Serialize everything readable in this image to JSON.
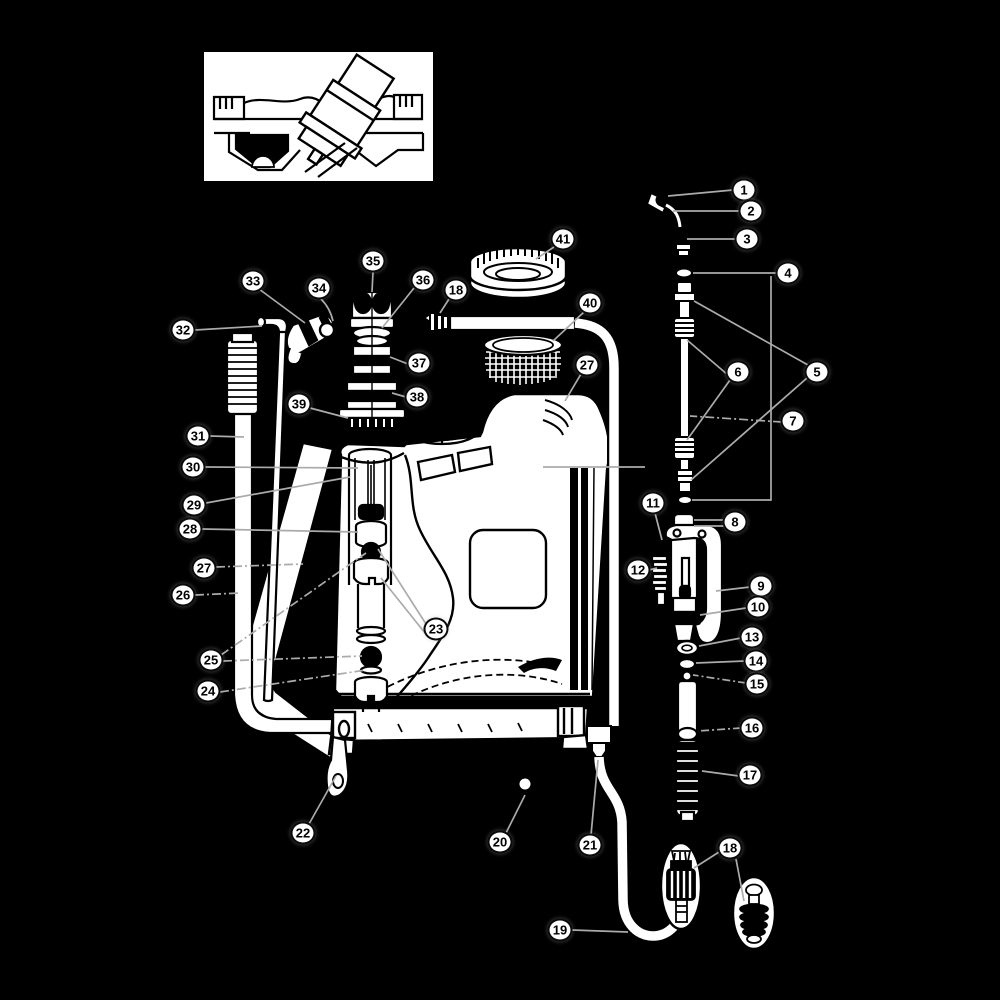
{
  "figure": {
    "type": "exploded-parts-diagram",
    "subject": "backpack-sprayer",
    "background_color": "#000000",
    "ink_color": "#000000",
    "paper_color": "#ffffff",
    "leader_line_color": "#ababab",
    "callout_count": 41
  },
  "callouts": [
    {
      "label": "1",
      "x": 744,
      "y": 190
    },
    {
      "label": "2",
      "x": 751,
      "y": 211
    },
    {
      "label": "3",
      "x": 747,
      "y": 239
    },
    {
      "label": "4",
      "x": 788,
      "y": 273
    },
    {
      "label": "5",
      "x": 817,
      "y": 372
    },
    {
      "label": "6",
      "x": 738,
      "y": 372
    },
    {
      "label": "7",
      "x": 793,
      "y": 421
    },
    {
      "label": "8",
      "x": 735,
      "y": 522
    },
    {
      "label": "9",
      "x": 761,
      "y": 586
    },
    {
      "label": "10",
      "x": 758,
      "y": 607
    },
    {
      "label": "11",
      "x": 653,
      "y": 503
    },
    {
      "label": "12",
      "x": 638,
      "y": 570
    },
    {
      "label": "13",
      "x": 752,
      "y": 637
    },
    {
      "label": "14",
      "x": 756,
      "y": 661
    },
    {
      "label": "15",
      "x": 757,
      "y": 684
    },
    {
      "label": "16",
      "x": 752,
      "y": 728
    },
    {
      "label": "17",
      "x": 750,
      "y": 775
    },
    {
      "label": "18",
      "x": 456,
      "y": 290
    },
    {
      "label": "18",
      "x": 730,
      "y": 848
    },
    {
      "label": "19",
      "x": 560,
      "y": 930
    },
    {
      "label": "20",
      "x": 500,
      "y": 842
    },
    {
      "label": "21",
      "x": 590,
      "y": 845
    },
    {
      "label": "22",
      "x": 303,
      "y": 833
    },
    {
      "label": "23",
      "x": 436,
      "y": 629
    },
    {
      "label": "24",
      "x": 208,
      "y": 691
    },
    {
      "label": "25",
      "x": 211,
      "y": 660
    },
    {
      "label": "26",
      "x": 183,
      "y": 595
    },
    {
      "label": "27",
      "x": 204,
      "y": 568
    },
    {
      "label": "27",
      "x": 587,
      "y": 365
    },
    {
      "label": "28",
      "x": 190,
      "y": 529
    },
    {
      "label": "29",
      "x": 194,
      "y": 505
    },
    {
      "label": "30",
      "x": 193,
      "y": 467
    },
    {
      "label": "31",
      "x": 198,
      "y": 436
    },
    {
      "label": "32",
      "x": 183,
      "y": 330
    },
    {
      "label": "33",
      "x": 253,
      "y": 281
    },
    {
      "label": "34",
      "x": 319,
      "y": 288
    },
    {
      "label": "35",
      "x": 373,
      "y": 261
    },
    {
      "label": "36",
      "x": 423,
      "y": 280
    },
    {
      "label": "37",
      "x": 419,
      "y": 363
    },
    {
      "label": "38",
      "x": 417,
      "y": 397
    },
    {
      "label": "39",
      "x": 299,
      "y": 404
    },
    {
      "label": "40",
      "x": 590,
      "y": 303
    },
    {
      "label": "41",
      "x": 563,
      "y": 239
    }
  ]
}
